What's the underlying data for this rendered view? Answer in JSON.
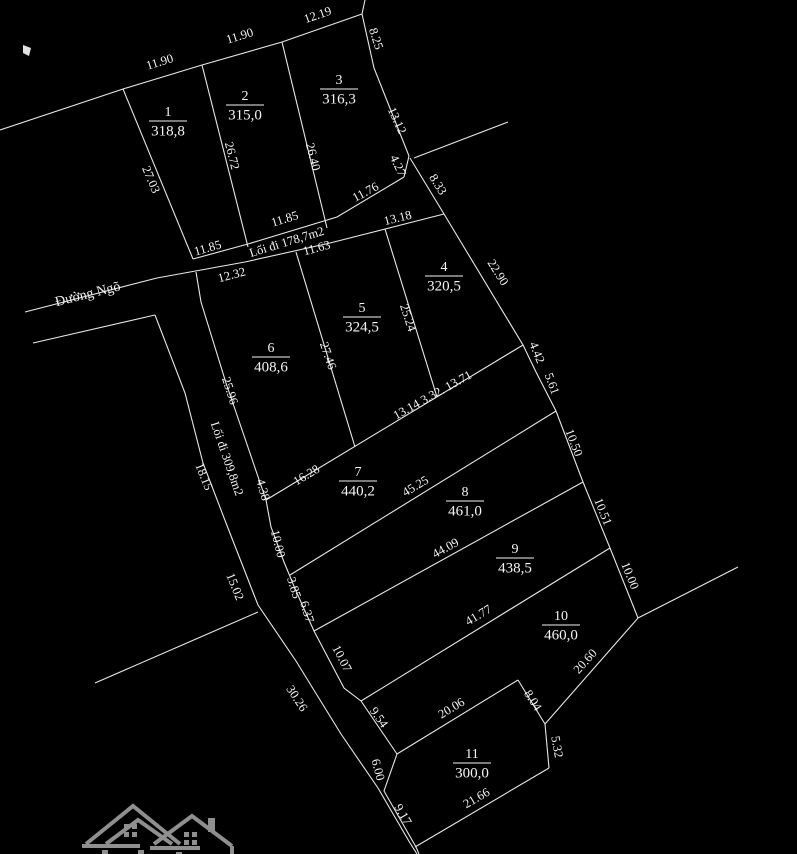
{
  "canvas": {
    "width": 797,
    "height": 854,
    "background": "#000000",
    "line_color": "#e8e8e8",
    "text_color": "#f5f5f5",
    "logo_color": "#8f8f8f",
    "dim_font_size": 12.5,
    "plot_number_font_size": 14,
    "plot_area_font_size": 15
  },
  "map": {
    "boundaries": [
      {
        "name": "outer-north-boundary",
        "points": [
          [
            0,
            130
          ],
          [
            123,
            89
          ],
          [
            202,
            65
          ],
          [
            282,
            42
          ],
          [
            362,
            14
          ]
        ]
      },
      {
        "name": "north-edge-tick",
        "points": [
          [
            362,
            14
          ],
          [
            365,
            0
          ]
        ]
      },
      {
        "name": "plot3-east-edge",
        "points": [
          [
            362,
            14
          ],
          [
            374,
            68
          ],
          [
            409,
            156
          ]
        ]
      },
      {
        "name": "edge-4-27",
        "points": [
          [
            409,
            156
          ],
          [
            404,
            177
          ]
        ]
      },
      {
        "name": "survey-stub-line",
        "points": [
          [
            414,
            158
          ],
          [
            508,
            122
          ]
        ]
      },
      {
        "name": "edge-8-33",
        "points": [
          [
            410,
            158
          ],
          [
            444,
            214
          ]
        ]
      },
      {
        "name": "plot1-west-edge",
        "points": [
          [
            123,
            89
          ],
          [
            193,
            259
          ]
        ]
      },
      {
        "name": "sep-plot1-plot2",
        "points": [
          [
            202,
            65
          ],
          [
            248,
            247
          ]
        ]
      },
      {
        "name": "sep-plot2-plot3",
        "points": [
          [
            282,
            42
          ],
          [
            327,
            228
          ]
        ]
      },
      {
        "name": "walkway178-north-line",
        "points": [
          [
            193,
            259
          ],
          [
            248,
            244
          ],
          [
            337,
            217
          ],
          [
            404,
            177
          ]
        ]
      },
      {
        "name": "walkway178-south-line",
        "points": [
          [
            157,
            278
          ],
          [
            245,
            262
          ],
          [
            330,
            243
          ],
          [
            444,
            214
          ]
        ]
      },
      {
        "name": "road-north-line",
        "points": [
          [
            25,
            312
          ],
          [
            157,
            278
          ]
        ]
      },
      {
        "name": "road-south-line",
        "points": [
          [
            33,
            343
          ],
          [
            155,
            315
          ]
        ]
      },
      {
        "name": "walkway309-west-line",
        "points": [
          [
            155,
            315
          ],
          [
            185,
            393
          ],
          [
            203,
            463
          ],
          [
            226,
            523
          ],
          [
            258,
            605
          ],
          [
            296,
            661
          ],
          [
            341,
            734
          ],
          [
            378,
            788
          ],
          [
            410,
            843
          ],
          [
            417,
            854
          ]
        ]
      },
      {
        "name": "walkway309-east-line",
        "points": [
          [
            196,
            272
          ],
          [
            201,
            302
          ],
          [
            226,
            383
          ],
          [
            266,
            500
          ],
          [
            271,
            527
          ],
          [
            284,
            562
          ],
          [
            296,
            591
          ],
          [
            314,
            631
          ],
          [
            344,
            688
          ],
          [
            361,
            701
          ],
          [
            397,
            754
          ]
        ]
      },
      {
        "name": "plot11-west-edge",
        "points": [
          [
            397,
            754
          ],
          [
            384,
            791
          ],
          [
            416,
            847
          ],
          [
            419,
            854
          ]
        ]
      },
      {
        "name": "east-boundary",
        "points": [
          [
            444,
            214
          ],
          [
            523,
            345
          ],
          [
            536,
            372
          ],
          [
            556,
            411
          ],
          [
            583,
            482
          ],
          [
            610,
            548
          ],
          [
            638,
            618
          ]
        ]
      },
      {
        "name": "east-spur-line",
        "points": [
          [
            638,
            618
          ],
          [
            738,
            567
          ]
        ]
      },
      {
        "name": "plots456-south-line",
        "points": [
          [
            266,
            500
          ],
          [
            523,
            345
          ]
        ]
      },
      {
        "name": "plot7-south-line",
        "points": [
          [
            290,
            575
          ],
          [
            556,
            411
          ]
        ]
      },
      {
        "name": "plot8-south-line",
        "points": [
          [
            314,
            631
          ],
          [
            583,
            482
          ]
        ]
      },
      {
        "name": "plot9-south-line",
        "points": [
          [
            361,
            701
          ],
          [
            610,
            548
          ]
        ]
      },
      {
        "name": "sep-plot4-plot5",
        "points": [
          [
            385,
            229
          ],
          [
            437,
            397
          ]
        ]
      },
      {
        "name": "sep-plot5-plot6",
        "points": [
          [
            296,
            252
          ],
          [
            355,
            447
          ]
        ]
      },
      {
        "name": "plot10-south-edge",
        "points": [
          [
            638,
            618
          ],
          [
            545,
            724
          ]
        ]
      },
      {
        "name": "plot11-north-edge",
        "points": [
          [
            397,
            754
          ],
          [
            518,
            680
          ]
        ]
      },
      {
        "name": "plot11-east-upper-edge",
        "points": [
          [
            518,
            680
          ],
          [
            545,
            724
          ]
        ]
      },
      {
        "name": "plot11-east-lower-edge",
        "points": [
          [
            545,
            724
          ],
          [
            549,
            768
          ]
        ]
      },
      {
        "name": "plot11-south-edge",
        "points": [
          [
            549,
            768
          ],
          [
            415,
            847
          ]
        ]
      },
      {
        "name": "west-neighbor-line",
        "points": [
          [
            95,
            683
          ],
          [
            258,
            612
          ]
        ]
      }
    ],
    "dimensions": [
      {
        "text": "11.90",
        "x": 160,
        "y": 63,
        "rot": -17
      },
      {
        "text": "11.90",
        "x": 240,
        "y": 37,
        "rot": -17
      },
      {
        "text": "12.19",
        "x": 318,
        "y": 16,
        "rot": -19
      },
      {
        "text": "8.25",
        "x": 375,
        "y": 39,
        "rot": 72
      },
      {
        "text": "27.03",
        "x": 150,
        "y": 180,
        "rot": 67
      },
      {
        "text": "26.72",
        "x": 231,
        "y": 156,
        "rot": 76
      },
      {
        "text": "26.40",
        "x": 312,
        "y": 157,
        "rot": 76
      },
      {
        "text": "13.12",
        "x": 396,
        "y": 121,
        "rot": 65
      },
      {
        "text": "4.27",
        "x": 397,
        "y": 166,
        "rot": 65
      },
      {
        "text": "8.33",
        "x": 437,
        "y": 185,
        "rot": 58
      },
      {
        "text": "11.76",
        "x": 366,
        "y": 193,
        "rot": -28
      },
      {
        "text": "11.85",
        "x": 285,
        "y": 220,
        "rot": -17
      },
      {
        "text": "11.85",
        "x": 208,
        "y": 249,
        "rot": -16
      },
      {
        "text": "Lối đi 178,7m2",
        "x": 287,
        "y": 243,
        "rot": -17
      },
      {
        "text": "11.63",
        "x": 317,
        "y": 249,
        "rot": -15
      },
      {
        "text": "12.32",
        "x": 232,
        "y": 276,
        "rot": -15
      },
      {
        "text": "13.18",
        "x": 398,
        "y": 219,
        "rot": -14
      },
      {
        "text": "22.90",
        "x": 497,
        "y": 273,
        "rot": 58
      },
      {
        "text": "Đường Ngõ",
        "x": 88,
        "y": 295,
        "rot": -14,
        "size": 14
      },
      {
        "text": "25.96",
        "x": 229,
        "y": 391,
        "rot": 72
      },
      {
        "text": "25.24",
        "x": 407,
        "y": 318,
        "rot": 72
      },
      {
        "text": "27.46",
        "x": 327,
        "y": 356,
        "rot": 71
      },
      {
        "text": "Lối đi 309,8m2",
        "x": 226,
        "y": 459,
        "rot": 71
      },
      {
        "text": "18.15",
        "x": 203,
        "y": 477,
        "rot": 68
      },
      {
        "text": "4.38",
        "x": 262,
        "y": 490,
        "rot": 74
      },
      {
        "text": "16.28",
        "x": 307,
        "y": 476,
        "rot": -31
      },
      {
        "text": "13.14 3.32. 13.71",
        "x": 433,
        "y": 396,
        "rot": -29
      },
      {
        "text": "45.25",
        "x": 416,
        "y": 487,
        "rot": -31
      },
      {
        "text": "10.00",
        "x": 277,
        "y": 544,
        "rot": 76
      },
      {
        "text": "3.85",
        "x": 293,
        "y": 588,
        "rot": 73
      },
      {
        "text": "6.37",
        "x": 306,
        "y": 612,
        "rot": 73
      },
      {
        "text": "44.09",
        "x": 446,
        "y": 549,
        "rot": -29
      },
      {
        "text": "4.42",
        "x": 536,
        "y": 353,
        "rot": 68
      },
      {
        "text": "5.61",
        "x": 551,
        "y": 384,
        "rot": 70
      },
      {
        "text": "10.50",
        "x": 573,
        "y": 443,
        "rot": 69
      },
      {
        "text": "10.51",
        "x": 602,
        "y": 512,
        "rot": 68
      },
      {
        "text": "10.00",
        "x": 629,
        "y": 576,
        "rot": 68
      },
      {
        "text": "41.77",
        "x": 479,
        "y": 616,
        "rot": -31
      },
      {
        "text": "20.60",
        "x": 586,
        "y": 662,
        "rot": -48
      },
      {
        "text": "20.06",
        "x": 452,
        "y": 709,
        "rot": -31
      },
      {
        "text": "8.04",
        "x": 532,
        "y": 701,
        "rot": 57
      },
      {
        "text": "5.32",
        "x": 556,
        "y": 747,
        "rot": 80
      },
      {
        "text": "21.66",
        "x": 477,
        "y": 799,
        "rot": -30
      },
      {
        "text": "9.17",
        "x": 402,
        "y": 815,
        "rot": 60
      },
      {
        "text": "6.00",
        "x": 377,
        "y": 770,
        "rot": 75
      },
      {
        "text": "9.54",
        "x": 378,
        "y": 718,
        "rot": 55
      },
      {
        "text": "10.07",
        "x": 341,
        "y": 659,
        "rot": 63
      },
      {
        "text": "30.26",
        "x": 296,
        "y": 699,
        "rot": 57
      },
      {
        "text": "15.02",
        "x": 234,
        "y": 587,
        "rot": 68
      }
    ],
    "plots": [
      {
        "number": "1",
        "area": "318,8",
        "x": 168,
        "y": 120
      },
      {
        "number": "2",
        "area": "315,0",
        "x": 245,
        "y": 104
      },
      {
        "number": "3",
        "area": "316,3",
        "x": 339,
        "y": 88
      },
      {
        "number": "4",
        "area": "320,5",
        "x": 444,
        "y": 275
      },
      {
        "number": "5",
        "area": "324,5",
        "x": 362,
        "y": 316
      },
      {
        "number": "6",
        "area": "408,6",
        "x": 271,
        "y": 356
      },
      {
        "number": "7",
        "area": "440,2",
        "x": 358,
        "y": 480
      },
      {
        "number": "8",
        "area": "461,0",
        "x": 465,
        "y": 500
      },
      {
        "number": "9",
        "area": "438,5",
        "x": 515,
        "y": 557
      },
      {
        "number": "10",
        "area": "460,0",
        "x": 561,
        "y": 624
      },
      {
        "number": "11",
        "area": "300,0",
        "x": 472,
        "y": 762
      }
    ],
    "cursor_mark": {
      "x": 27,
      "y": 51
    }
  }
}
